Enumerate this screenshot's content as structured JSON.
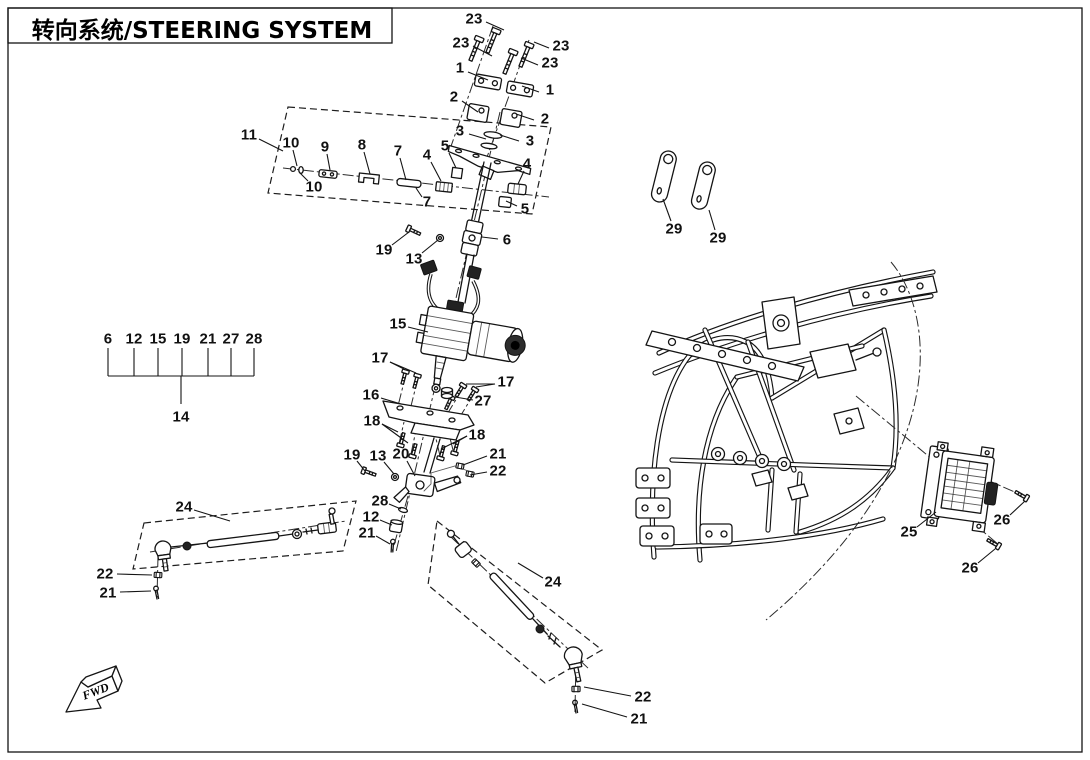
{
  "page": {
    "title": "转向系统/STEERING SYSTEM"
  },
  "fwd": {
    "label": "FWD"
  },
  "colors": {
    "line": "#141414",
    "background": "#ffffff"
  },
  "legend": {
    "numbers": [
      "6",
      "12",
      "15",
      "19",
      "21",
      "27",
      "28"
    ],
    "xs": [
      108,
      134,
      158,
      182,
      208,
      231,
      254
    ],
    "label_y": 339,
    "tick_top": 348,
    "bracket_y": 376,
    "stem_x": 181,
    "stem_bottom": 404,
    "group_label": "14",
    "group_y": 417
  },
  "callouts": [
    {
      "n": "23",
      "x": 474,
      "y": 19,
      "L": [
        [
          486,
          22,
          504,
          30
        ]
      ]
    },
    {
      "n": "23",
      "x": 461,
      "y": 43,
      "L": [
        [
          473,
          46,
          492,
          56
        ]
      ]
    },
    {
      "n": "23",
      "x": 561,
      "y": 46,
      "L": [
        [
          549,
          48,
          534,
          42
        ]
      ]
    },
    {
      "n": "23",
      "x": 550,
      "y": 63,
      "L": [
        [
          538,
          65,
          521,
          58
        ]
      ]
    },
    {
      "n": "1",
      "x": 460,
      "y": 68,
      "L": [
        [
          468,
          72,
          488,
          80
        ]
      ]
    },
    {
      "n": "1",
      "x": 550,
      "y": 90,
      "L": [
        [
          539,
          92,
          522,
          86
        ]
      ]
    },
    {
      "n": "2",
      "x": 454,
      "y": 97,
      "L": [
        [
          462,
          101,
          478,
          112
        ]
      ]
    },
    {
      "n": "2",
      "x": 545,
      "y": 119,
      "L": [
        [
          534,
          120,
          516,
          114
        ]
      ]
    },
    {
      "n": "3",
      "x": 460,
      "y": 131,
      "L": [
        [
          469,
          134,
          486,
          139
        ]
      ]
    },
    {
      "n": "3",
      "x": 530,
      "y": 141,
      "L": [
        [
          519,
          141,
          500,
          135
        ]
      ]
    },
    {
      "n": "11",
      "x": 249,
      "y": 135,
      "L": [
        [
          259,
          139,
          283,
          151
        ]
      ]
    },
    {
      "n": "10",
      "x": 291,
      "y": 143,
      "L": [
        [
          293,
          150,
          297,
          166
        ]
      ]
    },
    {
      "n": "9",
      "x": 325,
      "y": 147,
      "L": [
        [
          327,
          154,
          330,
          170
        ]
      ]
    },
    {
      "n": "8",
      "x": 362,
      "y": 145,
      "L": [
        [
          364,
          152,
          370,
          174
        ]
      ]
    },
    {
      "n": "7",
      "x": 398,
      "y": 151,
      "L": [
        [
          400,
          158,
          406,
          180
        ]
      ]
    },
    {
      "n": "4",
      "x": 427,
      "y": 155,
      "L": [
        [
          431,
          162,
          441,
          181
        ]
      ]
    },
    {
      "n": "5",
      "x": 445,
      "y": 146,
      "L": [
        [
          449,
          153,
          456,
          168
        ]
      ]
    },
    {
      "n": "10",
      "x": 314,
      "y": 187,
      "L": [
        [
          308,
          181,
          300,
          173
        ]
      ]
    },
    {
      "n": "7",
      "x": 427,
      "y": 202,
      "L": [
        [
          422,
          197,
          416,
          188
        ]
      ]
    },
    {
      "n": "4",
      "x": 527,
      "y": 164,
      "L": [
        [
          524,
          171,
          518,
          184
        ]
      ]
    },
    {
      "n": "5",
      "x": 525,
      "y": 209,
      "L": [
        [
          517,
          206,
          506,
          201
        ]
      ]
    },
    {
      "n": "19",
      "x": 384,
      "y": 250,
      "L": [
        [
          392,
          245,
          409,
          232
        ]
      ]
    },
    {
      "n": "13",
      "x": 414,
      "y": 259,
      "L": [
        [
          422,
          253,
          438,
          240
        ]
      ]
    },
    {
      "n": "6",
      "x": 507,
      "y": 240,
      "L": [
        [
          498,
          239,
          482,
          237
        ]
      ]
    },
    {
      "n": "15",
      "x": 398,
      "y": 324,
      "L": [
        [
          408,
          327,
          428,
          332
        ]
      ]
    },
    {
      "n": "17",
      "x": 380,
      "y": 358,
      "L": [
        [
          390,
          362,
          404,
          369
        ],
        [
          390,
          362,
          416,
          373
        ]
      ]
    },
    {
      "n": "17",
      "x": 506,
      "y": 382,
      "L": [
        [
          495,
          384,
          476,
          387
        ],
        [
          495,
          384,
          466,
          384
        ]
      ]
    },
    {
      "n": "16",
      "x": 371,
      "y": 395,
      "L": [
        [
          381,
          398,
          401,
          404
        ]
      ]
    },
    {
      "n": "27",
      "x": 483,
      "y": 401,
      "L": [
        [
          473,
          400,
          455,
          397
        ]
      ]
    },
    {
      "n": "18",
      "x": 372,
      "y": 421,
      "L": [
        [
          382,
          424,
          398,
          432
        ],
        [
          382,
          424,
          408,
          443
        ]
      ]
    },
    {
      "n": "18",
      "x": 477,
      "y": 435,
      "L": [
        [
          467,
          436,
          453,
          444
        ],
        [
          467,
          436,
          441,
          449
        ]
      ]
    },
    {
      "n": "19",
      "x": 352,
      "y": 455,
      "L": [
        [
          357,
          461,
          365,
          471
        ]
      ]
    },
    {
      "n": "13",
      "x": 378,
      "y": 456,
      "L": [
        [
          384,
          462,
          394,
          474
        ]
      ]
    },
    {
      "n": "20",
      "x": 401,
      "y": 454,
      "L": [
        [
          407,
          461,
          415,
          476
        ]
      ]
    },
    {
      "n": "21",
      "x": 498,
      "y": 454,
      "L": [
        [
          487,
          456,
          463,
          465
        ]
      ]
    },
    {
      "n": "22",
      "x": 498,
      "y": 471,
      "L": [
        [
          487,
          472,
          470,
          475
        ]
      ]
    },
    {
      "n": "28",
      "x": 380,
      "y": 501,
      "L": [
        [
          389,
          504,
          401,
          509
        ]
      ]
    },
    {
      "n": "12",
      "x": 371,
      "y": 517,
      "L": [
        [
          380,
          520,
          392,
          525
        ]
      ]
    },
    {
      "n": "21",
      "x": 367,
      "y": 533,
      "L": [
        [
          376,
          536,
          390,
          544
        ]
      ]
    },
    {
      "n": "24",
      "x": 184,
      "y": 507,
      "L": [
        [
          194,
          510,
          230,
          521
        ]
      ]
    },
    {
      "n": "22",
      "x": 105,
      "y": 574,
      "L": [
        [
          117,
          574,
          152,
          575
        ]
      ]
    },
    {
      "n": "21",
      "x": 108,
      "y": 593,
      "L": [
        [
          120,
          592,
          151,
          591
        ]
      ]
    },
    {
      "n": "24",
      "x": 553,
      "y": 582,
      "L": [
        [
          543,
          578,
          518,
          563
        ]
      ]
    },
    {
      "n": "22",
      "x": 643,
      "y": 697,
      "L": [
        [
          631,
          696,
          584,
          687
        ]
      ]
    },
    {
      "n": "21",
      "x": 639,
      "y": 719,
      "L": [
        [
          627,
          717,
          582,
          704
        ]
      ]
    },
    {
      "n": "29",
      "x": 674,
      "y": 229,
      "L": [
        [
          671,
          221,
          663,
          199
        ]
      ]
    },
    {
      "n": "29",
      "x": 718,
      "y": 238,
      "L": [
        [
          715,
          230,
          709,
          210
        ]
      ]
    },
    {
      "n": "25",
      "x": 909,
      "y": 532,
      "L": [
        [
          917,
          527,
          936,
          512
        ]
      ]
    },
    {
      "n": "26",
      "x": 1002,
      "y": 520,
      "L": [
        [
          1010,
          515,
          1025,
          501
        ]
      ]
    },
    {
      "n": "26",
      "x": 970,
      "y": 568,
      "L": [
        [
          978,
          563,
          995,
          549
        ]
      ]
    }
  ]
}
